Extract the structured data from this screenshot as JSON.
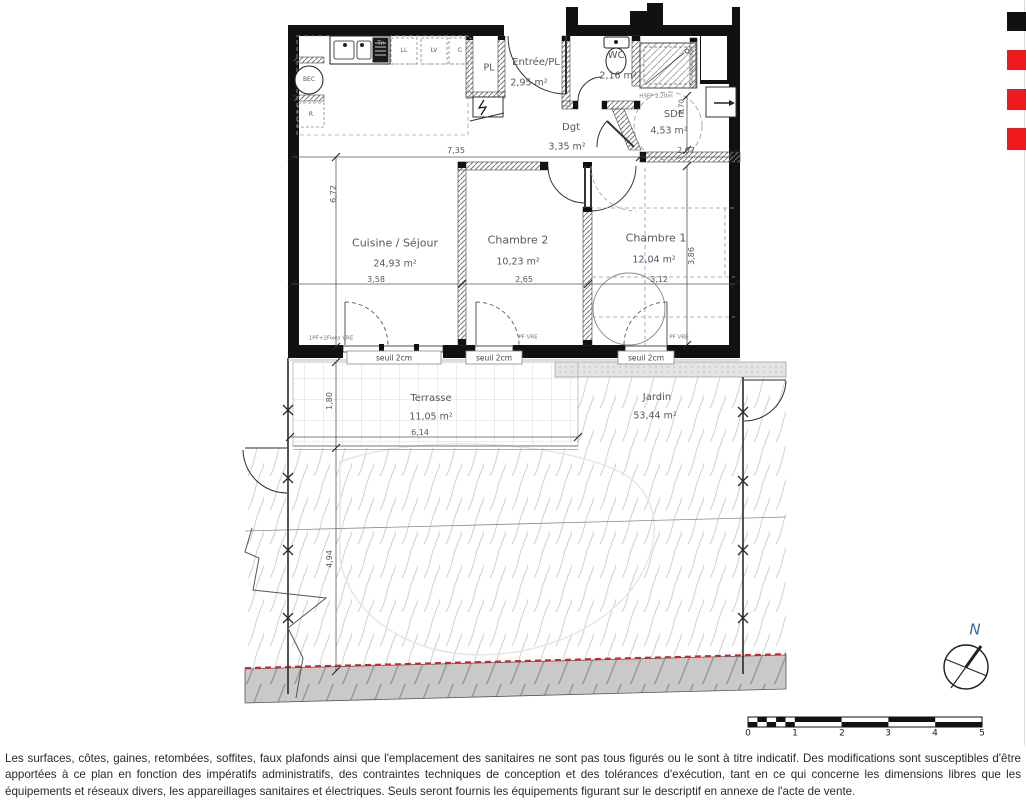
{
  "rooms": {
    "cuisine": {
      "name": "Cuisine / Séjour",
      "area": "24,93 m²"
    },
    "chambre2": {
      "name": "Chambre 2",
      "area": "10,23 m²"
    },
    "chambre1": {
      "name": "Chambre 1",
      "area": "12,04 m²"
    },
    "entree": {
      "name": "Entrée/PL",
      "area": "2,95 m²"
    },
    "wc": {
      "name": "WC",
      "area": "2,16 m²"
    },
    "sde": {
      "name": "SDE",
      "area": "4,53 m²"
    },
    "degagement": {
      "name": "Dgt",
      "area": "3,35 m²"
    },
    "placard": {
      "name": "PL"
    },
    "terrasse": {
      "name": "Terrasse",
      "area": "11,05 m²"
    },
    "jardin": {
      "name": "Jardin",
      "area": "53,44 m²"
    }
  },
  "dims": {
    "d735": "7,35",
    "d207": "2,07",
    "d672": "6,72",
    "d358": "3,58",
    "d265": "2,65",
    "d312": "3,12",
    "d386": "3,86",
    "d270": "2,70",
    "d180": "1,80",
    "d614": "6,14",
    "d494": "4,94"
  },
  "labels": {
    "seuil": "seuil 2cm",
    "win_living": "1PF+2Fixes VRE",
    "win_pf": "PF VRE",
    "hsfp": "HSFP 2,20m"
  },
  "kitchen": {
    "ll": "LL",
    "lv": "LV",
    "c": "C",
    "tn": "Tn",
    "bec": "BEC",
    "r": "R"
  },
  "compass": {
    "north": "N"
  },
  "scale": {
    "t0": "0",
    "t1": "1",
    "t2": "2",
    "t3": "3",
    "t4": "4",
    "t5": "5"
  },
  "colors": {
    "accent_red": "#f01a1e",
    "label_blue": "#4d5a66",
    "north_blue": "#2e6da4"
  },
  "footer": {
    "disclaimer": "Les surfaces, côtes, gaines, retombées, soffites, faux plafonds ainsi que l'emplacement des sanitaires ne sont pas tous figurés ou le sont à titre indicatif. Des modifications sont susceptibles d'être apportées à ce plan en fonction des impératifs administratifs, des contraintes techniques de conception et des tolérances d'exécution, tant en ce qui concerne les dimensions libres que les équipements et réseaux divers, les appareillages sanitaires et électriques. Seuls seront fournis les équipements figurant sur le descriptif en annexe de l'acte de vente."
  }
}
